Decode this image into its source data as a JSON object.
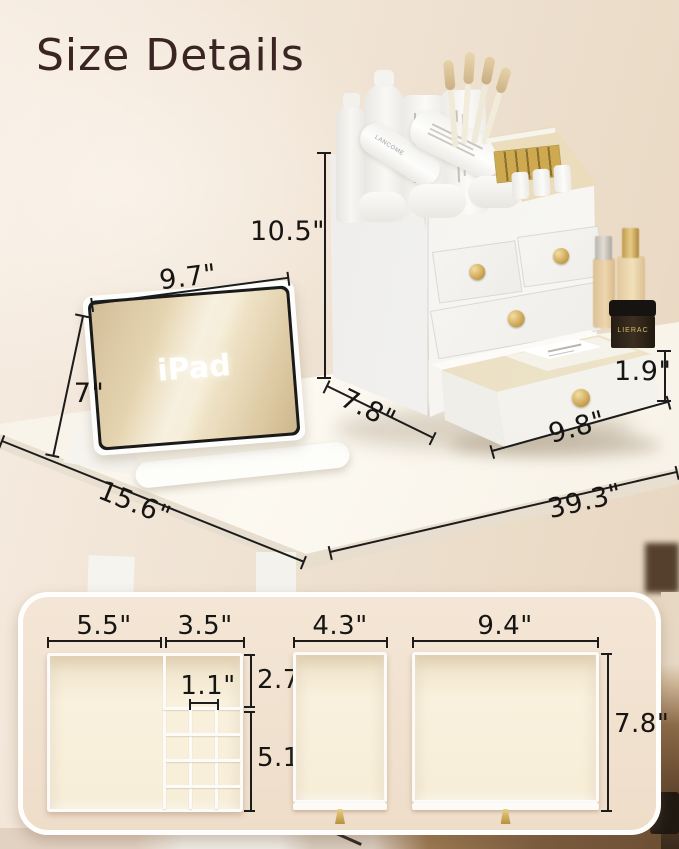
{
  "title": "Size Details",
  "labels": {
    "ipad_screen": "iPad",
    "tube_brand": "LANCOME",
    "jar_brand": "LIERAC"
  },
  "dims_photo": {
    "organizer_height": "10.5\"",
    "organizer_depth": "7.8\"",
    "open_drawer_height": "1.9\"",
    "open_drawer_width": "9.8\"",
    "ipad_width": "9.7\"",
    "ipad_height": "7\"",
    "desk_depth": "15.6\"",
    "desk_length": "39.3\""
  },
  "dims_panel": {
    "tray_left_width": "5.5\"",
    "tray_right_width": "3.5\"",
    "tray_cell_width": "1.1\"",
    "tray_top_height": "2.7\"",
    "tray_grid_height": "5.1\"",
    "small_drawer_width": "4.3\"",
    "large_drawer_width": "9.4\"",
    "large_drawer_height": "7.8\""
  },
  "colors": {
    "accent_gold": "#d2ab5c",
    "title_brown": "#3b2522",
    "dimension_line": "#1c1c1c",
    "panel_cream": "#f2e2d0",
    "tray_cream": "#f8efdb"
  }
}
